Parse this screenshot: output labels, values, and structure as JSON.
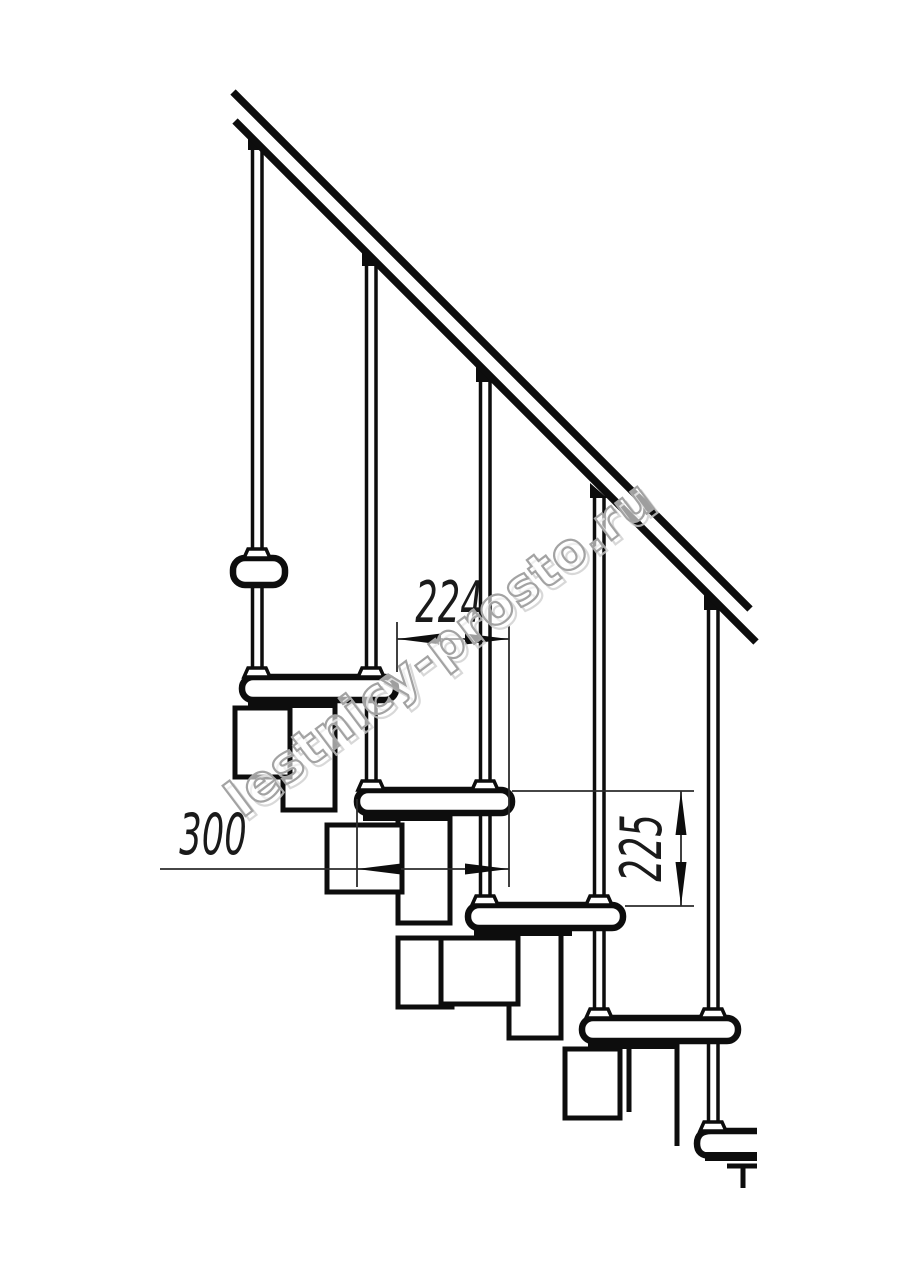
{
  "drawing": {
    "title": "modular-staircase-side-elevation",
    "watermark": {
      "text": "lestnicy-prosto.ru",
      "color": "#a3a3a3"
    },
    "dimensions": {
      "tread_run": "224",
      "tread_depth": "300",
      "step_height": "225"
    },
    "colors": {
      "line": "#0d0d0d",
      "dimension_line": "#2b2b2b",
      "background": "#ffffff"
    }
  }
}
